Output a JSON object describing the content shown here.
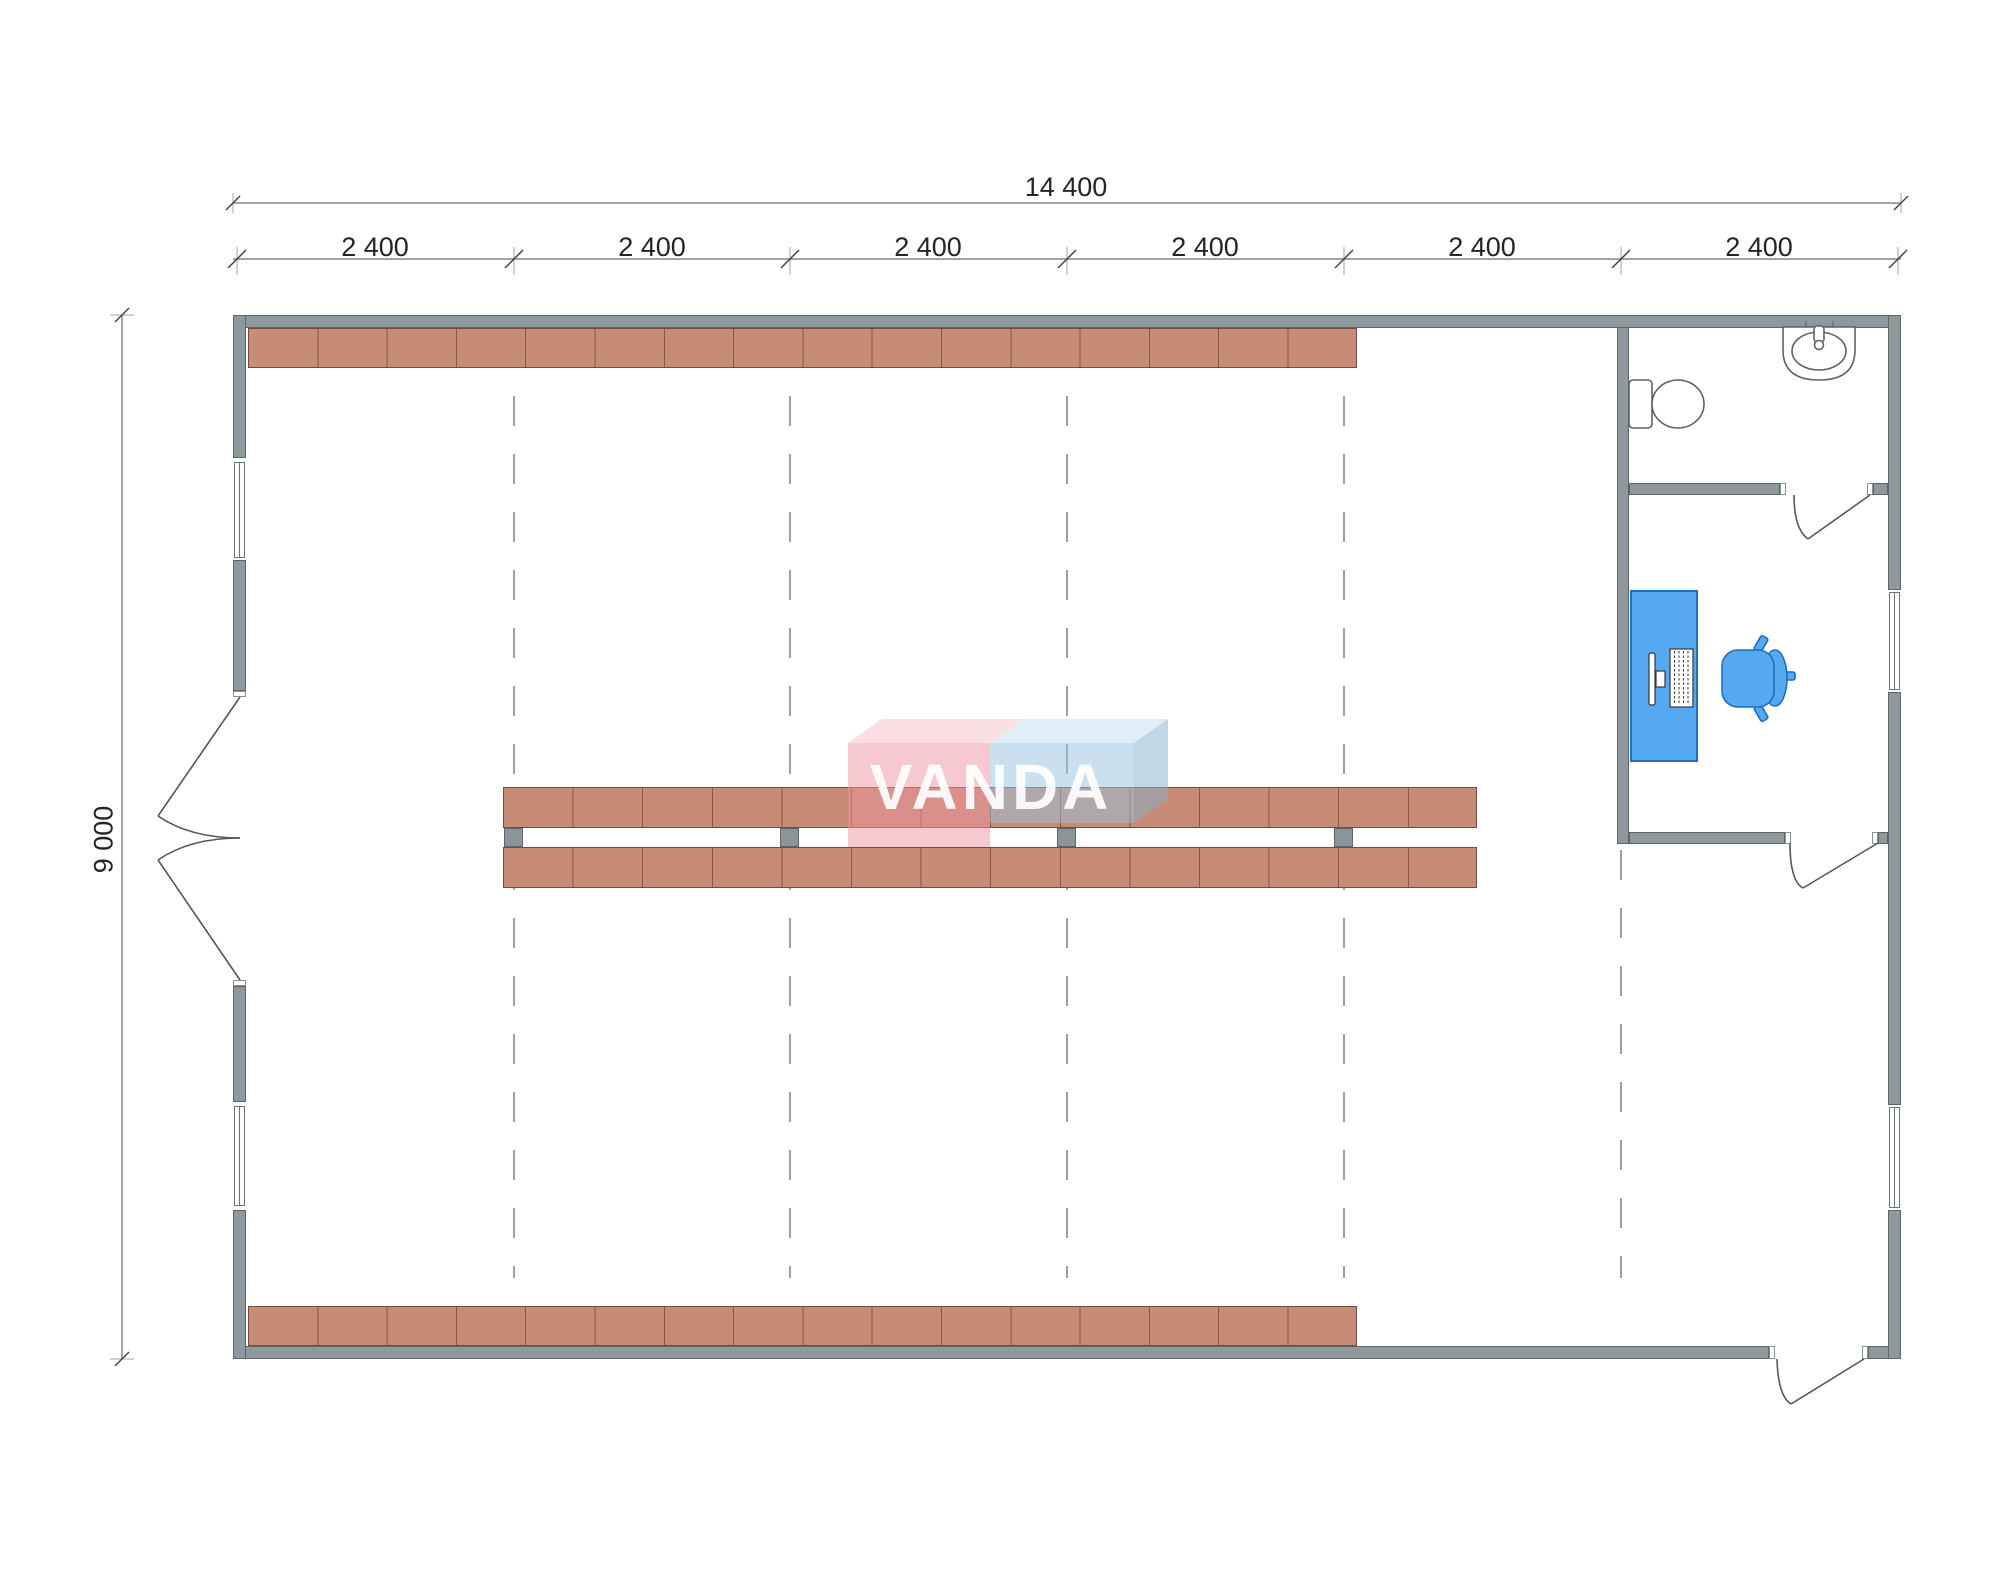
{
  "watermark": {
    "text": "VANDA"
  },
  "dimensions": {
    "total_width_label": "14 400",
    "bay_labels": [
      "2 400",
      "2 400",
      "2 400",
      "2 400",
      "2 400",
      "2 400"
    ],
    "total_height_label": "9 000"
  },
  "colors": {
    "wall_gray": "#8f999d",
    "shelving_salmon": "#c78c75",
    "furniture_blue": "#55a9f0",
    "watermark_pink": "#f5c9cf",
    "watermark_blue": "#cbe0ee",
    "dashed_grid": "#7b8084"
  },
  "fixtures": [
    "toilet",
    "sink",
    "desk",
    "monitor",
    "keyboard",
    "office-chair",
    "shelving-rack",
    "support-column",
    "swing-door",
    "double-swing-door",
    "window"
  ]
}
